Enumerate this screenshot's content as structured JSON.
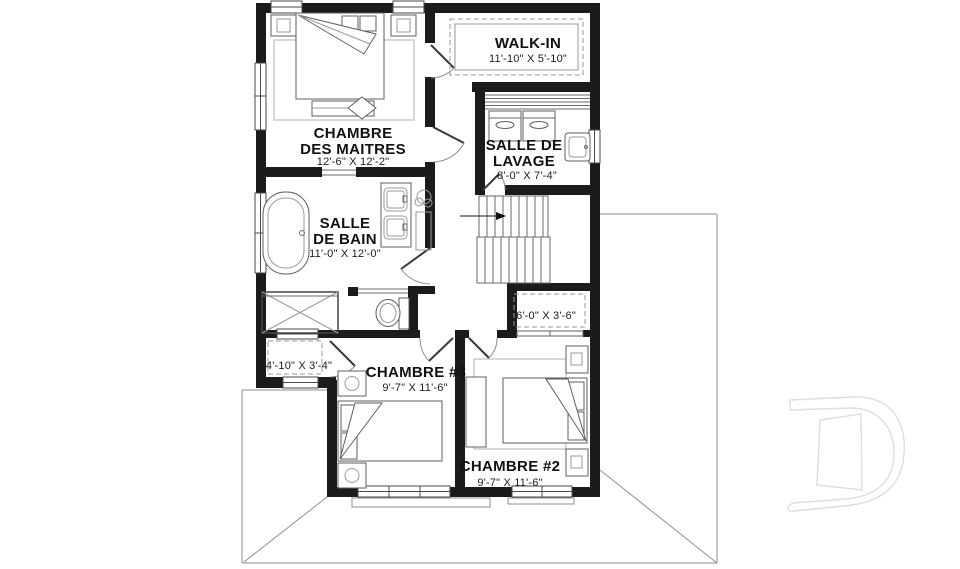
{
  "plan": {
    "watermark_letter": "D",
    "rooms": [
      {
        "id": "walk-in",
        "name": "WALK-IN",
        "dims": "11'-10\" X 5'-10\""
      },
      {
        "id": "master-bedroom",
        "name_line1": "CHAMBRE",
        "name_line2": "DES MAITRES",
        "dims": "12'-6\" X 12'-2\""
      },
      {
        "id": "laundry-room",
        "name_line1": "SALLE DE",
        "name_line2": "LAVAGE",
        "dims": "8'-0\" X 7'-4\""
      },
      {
        "id": "bathroom",
        "name_line1": "SALLE",
        "name_line2": "DE BAIN",
        "dims": "11'-0\" X 12'-0\""
      },
      {
        "id": "closet-bedroom2",
        "dims": "6'-0\" X 3'-6\""
      },
      {
        "id": "closet-bedroom3",
        "dims": "4'-10\" X 3'-4\""
      },
      {
        "id": "bedroom-3",
        "name": "CHAMBRE #3",
        "dims": "9'-7\" X 11'-6\""
      },
      {
        "id": "bedroom-2",
        "name": "CHAMBRE #2",
        "dims": "9'-7\" X 11'-6\""
      }
    ]
  }
}
